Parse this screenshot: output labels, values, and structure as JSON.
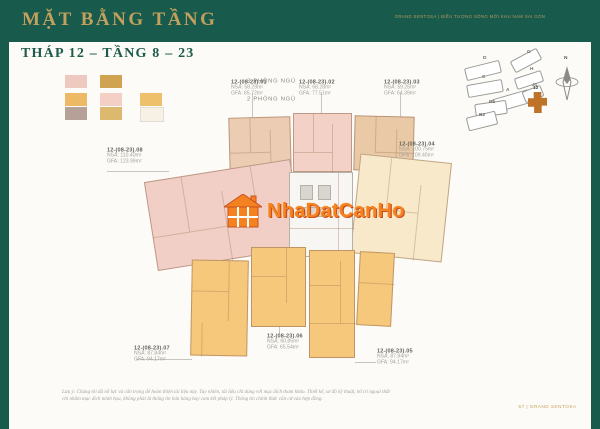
{
  "header": {
    "title": "MẶT BẰNG TẦNG",
    "tagline": "GRAND SENTOSA  |  BIỂU TƯỢNG SỐNG MỚI KHU NAM SÀI GÒN"
  },
  "subtitle": "THÁP 12 – TẦNG 8 – 23",
  "legend": {
    "row1_label": "3 PHÒNG NGỦ",
    "row2_label": "2 PHÒNG NGỦ",
    "row1_colors": [
      "#eec9bf",
      "#cfa350"
    ],
    "row2_colors": [
      "#eeb964",
      "#f3cfc5",
      "#efc06b"
    ],
    "row3_colors": [
      "#b5a198",
      "#dcb96e",
      "#f7f1e5"
    ]
  },
  "units": [
    {
      "id": "12-(08-23).01",
      "nsa": "NSA: 58.29m²",
      "gfa": "GFA: 65.72m²"
    },
    {
      "id": "12-(08-23).02",
      "nsa": "NSA: 68.28m²",
      "gfa": "GFA: 77.51m²"
    },
    {
      "id": "12-(08-23).03",
      "nsa": "NSA: 59.26m²",
      "gfa": "GFA: 64.39m²"
    },
    {
      "id": "12-(08-23).04",
      "nsa": "NSA: 100.75m²",
      "gfa": "GFA: 109.40m²"
    },
    {
      "id": "12-(08-23).05",
      "nsa": "NSA: 87.84m²",
      "gfa": "GFA: 94.17m²"
    },
    {
      "id": "12-(08-23).06",
      "nsa": "NSA: 60.85m²",
      "gfa": "GFA: 65.54m²"
    },
    {
      "id": "12-(08-23).07",
      "nsa": "NSA: 87.84m²",
      "gfa": "GFA: 94.17m²"
    },
    {
      "id": "12-(08-23).08",
      "nsa": "NSA: 110.40m²",
      "gfa": "GFA: 123.99m²"
    }
  ],
  "site_map": {
    "buildings": [
      {
        "label": "D"
      },
      {
        "label": "G"
      },
      {
        "label": "H"
      },
      {
        "label": "C"
      },
      {
        "label": "A"
      },
      {
        "label": "J1"
      },
      {
        "label": "B1"
      },
      {
        "label": "B2"
      }
    ],
    "highlight_label": "12",
    "compass_label": "N"
  },
  "watermark": {
    "text": "NhaDatCanHo"
  },
  "footer": {
    "note_line1": "Lưu ý: Chúng tôi đã nỗ lực và cẩn trọng để hoàn thiện tài liệu này. Tuy nhiên, tài liệu chỉ dùng với mục đích tham khảo. Thiết kế, sơ đồ kỹ thuật, bố trí ngoại thất",
    "note_line2": "chỉ nhằm mục đích minh họa, không phải là thông tin bán hàng hay cam kết pháp lý. Thông tin chính thức căn cứ vào hợp đồng.",
    "page": "57 | GRAND SENTOSA"
  },
  "colors": {
    "frame_green": "#185a4b",
    "title_gold": "#c2a05e",
    "watermark_orange": "#f58220",
    "unit_orange": "#f6c87c",
    "unit_pink": "#f2cfc6",
    "unit_cream": "#f8e9cb"
  }
}
